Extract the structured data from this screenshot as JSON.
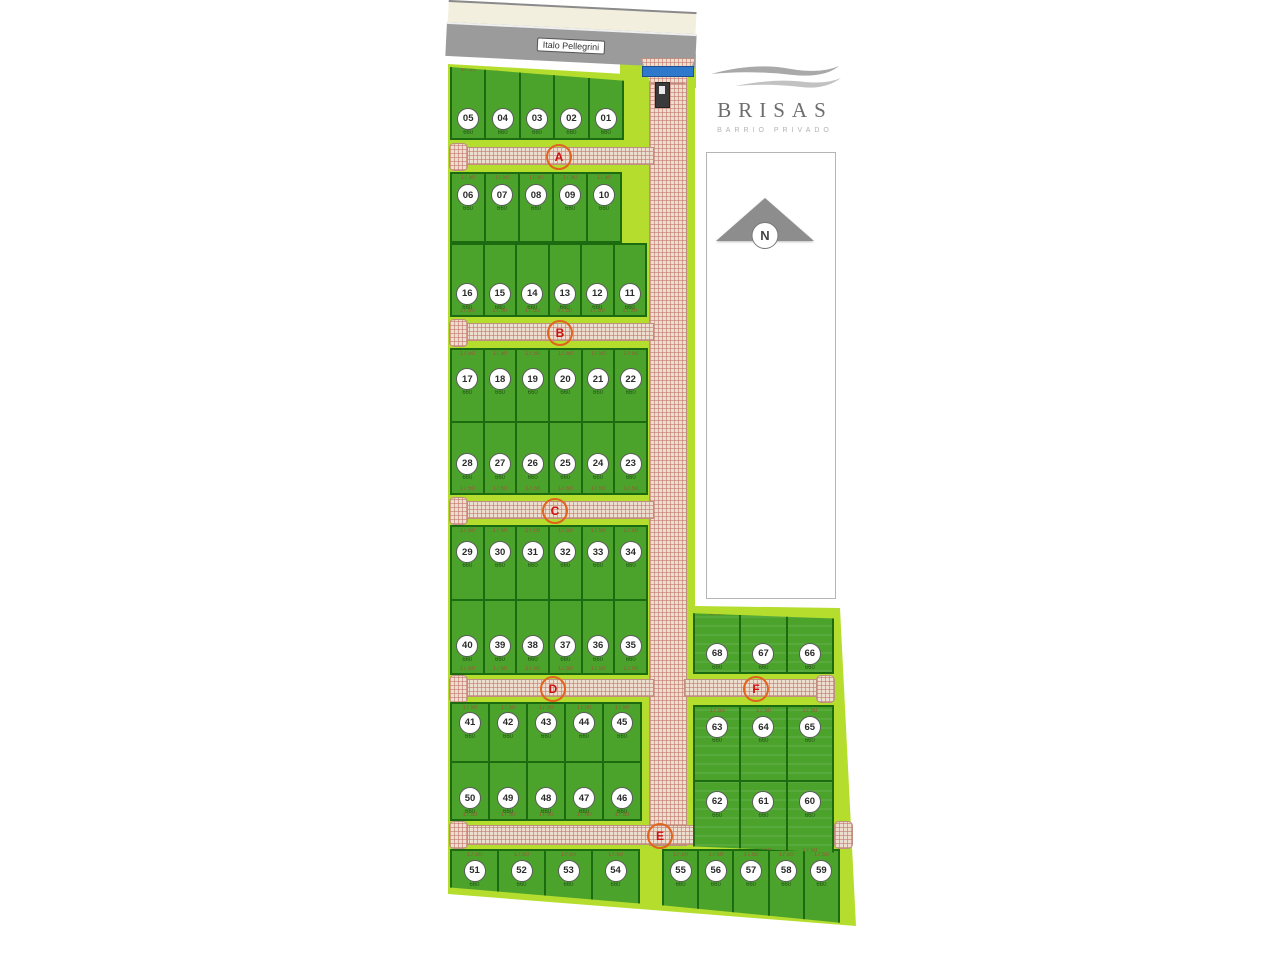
{
  "logo": {
    "name": "BRISAS",
    "subtitle": "BARRIO PRIVADO"
  },
  "road": {
    "label": "Italo Pellegrini"
  },
  "north": {
    "label": "N"
  },
  "annotations": {
    "frontage": "17.50",
    "area": "660"
  },
  "colors": {
    "grounds": "#b5dd2e",
    "lot": "#4ba32c",
    "lot_border": "#1c6b10",
    "street_base": "#ecdfd0",
    "street_hatch": "#c6766c",
    "road": "#9b9b9b",
    "gate": "#2f79cc",
    "street_tag_ring": "#e0641e",
    "street_tag_text": "#cc1111"
  },
  "main_street": {
    "x": 649,
    "y": 80,
    "w": 36,
    "h": 764
  },
  "streets": [
    {
      "label": "A",
      "x": 452,
      "y": 147,
      "w": 200,
      "h": 16,
      "bulbs": [
        "left"
      ],
      "tag_x": 557,
      "tag_y": 155
    },
    {
      "label": "B",
      "x": 452,
      "y": 323,
      "w": 200,
      "h": 16,
      "bulbs": [
        "left"
      ],
      "tag_x": 558,
      "tag_y": 331
    },
    {
      "label": "C",
      "x": 452,
      "y": 501,
      "w": 200,
      "h": 16,
      "bulbs": [
        "left"
      ],
      "tag_x": 553,
      "tag_y": 509
    },
    {
      "label": "D",
      "x": 452,
      "y": 679,
      "w": 200,
      "h": 16,
      "bulbs": [
        "left"
      ],
      "tag_x": 551,
      "tag_y": 687
    },
    {
      "label": "E",
      "x": 452,
      "y": 825,
      "w": 396,
      "h": 18,
      "bulbs": [
        "left",
        "right"
      ],
      "tag_x": 658,
      "tag_y": 834
    },
    {
      "label": "F",
      "x": 684,
      "y": 679,
      "w": 146,
      "h": 16,
      "bulbs": [
        "right"
      ],
      "tag_x": 754,
      "tag_y": 687
    }
  ],
  "blocks": [
    {
      "x": 450,
      "y": 64,
      "w": 174,
      "h": 76,
      "clip": "polygon(0 4%,100% 22%,100% 100%,0 100%)",
      "rows": [
        {
          "lots": [
            "05",
            "04",
            "03",
            "02",
            "01"
          ],
          "cy": 58,
          "dims": "top"
        }
      ]
    },
    {
      "x": 450,
      "y": 172,
      "w": 172,
      "h": 71,
      "rows": [
        {
          "lots": [
            "06",
            "07",
            "08",
            "09",
            "10"
          ],
          "cy": 15,
          "dims": "top"
        }
      ]
    },
    {
      "x": 450,
      "y": 243,
      "w": 197,
      "h": 74,
      "rows": [
        {
          "lots": [
            "16",
            "15",
            "14",
            "13",
            "12",
            "11"
          ],
          "cy": 54,
          "dims": "bottom"
        }
      ]
    },
    {
      "x": 450,
      "y": 348,
      "w": 198,
      "h": 147,
      "rows": [
        {
          "lots": [
            "17",
            "18",
            "19",
            "20",
            "21",
            "22"
          ],
          "cy": 26,
          "dims": "top"
        },
        {
          "lots": [
            "28",
            "27",
            "26",
            "25",
            "24",
            "23"
          ],
          "cy": 43,
          "dims": "bottom"
        }
      ]
    },
    {
      "x": 450,
      "y": 525,
      "w": 198,
      "h": 150,
      "rows": [
        {
          "lots": [
            "29",
            "30",
            "31",
            "32",
            "33",
            "34"
          ],
          "cy": 20,
          "dims": "top"
        },
        {
          "lots": [
            "40",
            "39",
            "38",
            "37",
            "36",
            "35"
          ],
          "cy": 47,
          "dims": "bottom"
        }
      ]
    },
    {
      "x": 450,
      "y": 702,
      "w": 192,
      "h": 119,
      "rows": [
        {
          "lots": [
            "41",
            "42",
            "43",
            "44",
            "45"
          ],
          "cy": 14,
          "dims": "top"
        },
        {
          "lots": [
            "50",
            "49",
            "48",
            "47",
            "46"
          ],
          "cy": 44,
          "dims": "bottom"
        }
      ]
    },
    {
      "x": 450,
      "y": 849,
      "w": 190,
      "h": 62,
      "clip": "polygon(0 0,100% 0,100% 88%,0 62%)",
      "rows": [
        {
          "lots": [
            "51",
            "52",
            "53",
            "54"
          ],
          "cy": 15,
          "dims": "top"
        }
      ]
    },
    {
      "x": 662,
      "y": 849,
      "w": 178,
      "h": 76,
      "clip": "polygon(0 0,100% 0,100% 97%,0 74%)",
      "rows": [
        {
          "lots": [
            "55",
            "56",
            "57",
            "58",
            "59"
          ],
          "cy": 12,
          "dims": "top"
        }
      ]
    },
    {
      "x": 693,
      "y": 608,
      "w": 141,
      "h": 66,
      "clip": "polygon(0 8%,100% 16%,100% 100%,0 100%)",
      "stripes": true,
      "rows": [
        {
          "lots": [
            "68",
            "67",
            "66"
          ],
          "cy": 53,
          "dims": "top"
        }
      ]
    },
    {
      "x": 693,
      "y": 705,
      "w": 141,
      "h": 152,
      "clip": "polygon(0 0,100% 0,100% 97%,0 93%)",
      "stripes": true,
      "rows": [
        {
          "lots": [
            "63",
            "64",
            "65"
          ],
          "cy": 13,
          "dims": "top"
        },
        {
          "lots": [
            "62",
            "61",
            "60"
          ],
          "cy": 12,
          "dims": "bottom"
        }
      ]
    }
  ]
}
